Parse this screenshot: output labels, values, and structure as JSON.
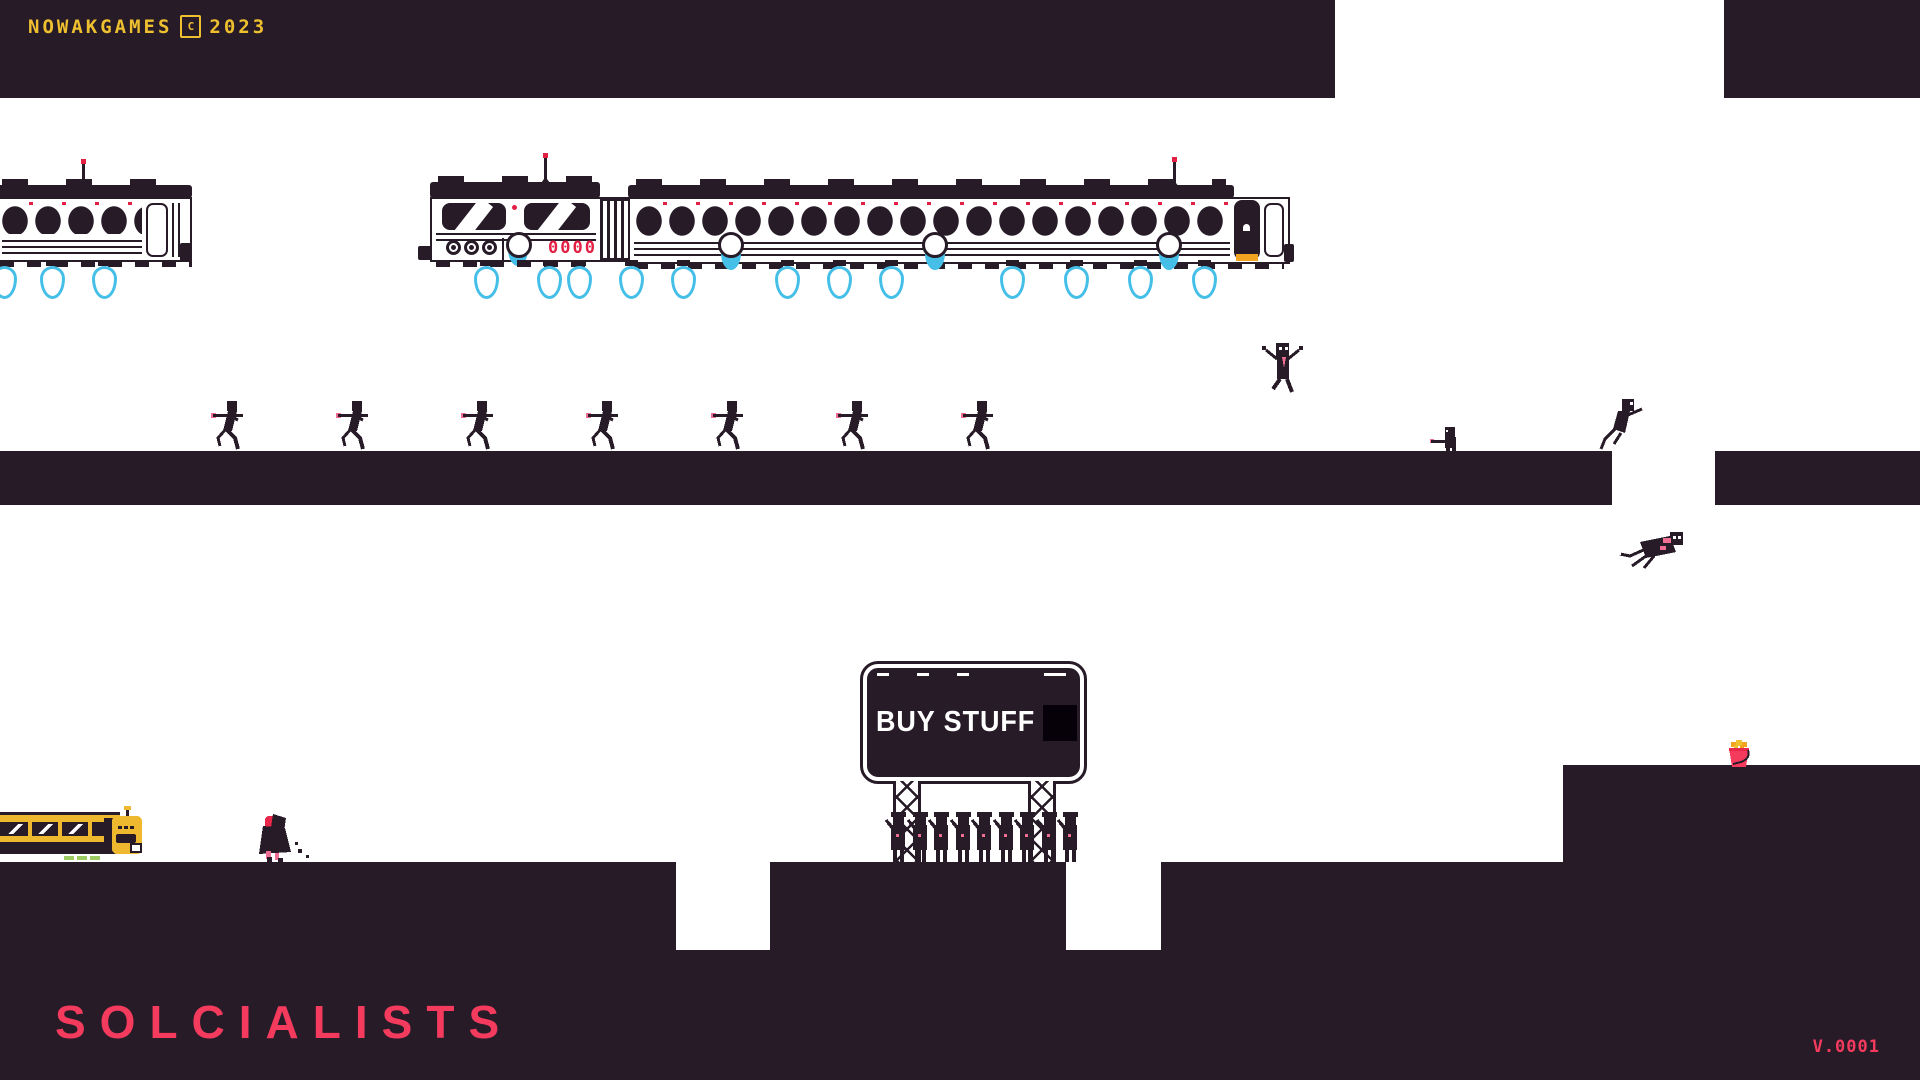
{
  "colors": {
    "dark": "#271b28",
    "ink": "#060109",
    "yellow": "#eec02f",
    "pink": "#f43b5e",
    "red": "#e41f44",
    "cyan": "#45bfe8",
    "green": "#9ccb64",
    "orange": "#f2a31f",
    "redhead": "#e8274b",
    "accent": "#ef6e93",
    "busyellow": "#eeb92e"
  },
  "header": {
    "studio": "NOWAKGAMES",
    "copyright": "C",
    "year": "2023"
  },
  "billboard": {
    "text": "BUY STUFF"
  },
  "train": {
    "loco_digits": "0000"
  },
  "title": {
    "text": "SOLCIALISTS"
  },
  "version": {
    "text": "V.0001"
  },
  "sprites": {
    "runners": [
      211,
      336,
      461,
      586,
      711,
      836,
      961
    ],
    "queue": [
      884,
      906,
      927,
      949,
      970,
      992,
      1013,
      1035,
      1056
    ],
    "flames": [
      -8,
      40,
      92,
      474,
      537,
      567,
      619,
      671,
      775,
      827,
      879,
      1000,
      1064,
      1128,
      1192
    ],
    "pods": [
      718,
      922,
      1156
    ],
    "antennas": [
      {
        "x": 82,
        "y": 163
      },
      {
        "x": 544,
        "y": 157
      },
      {
        "x": 1173,
        "y": 161
      }
    ]
  }
}
